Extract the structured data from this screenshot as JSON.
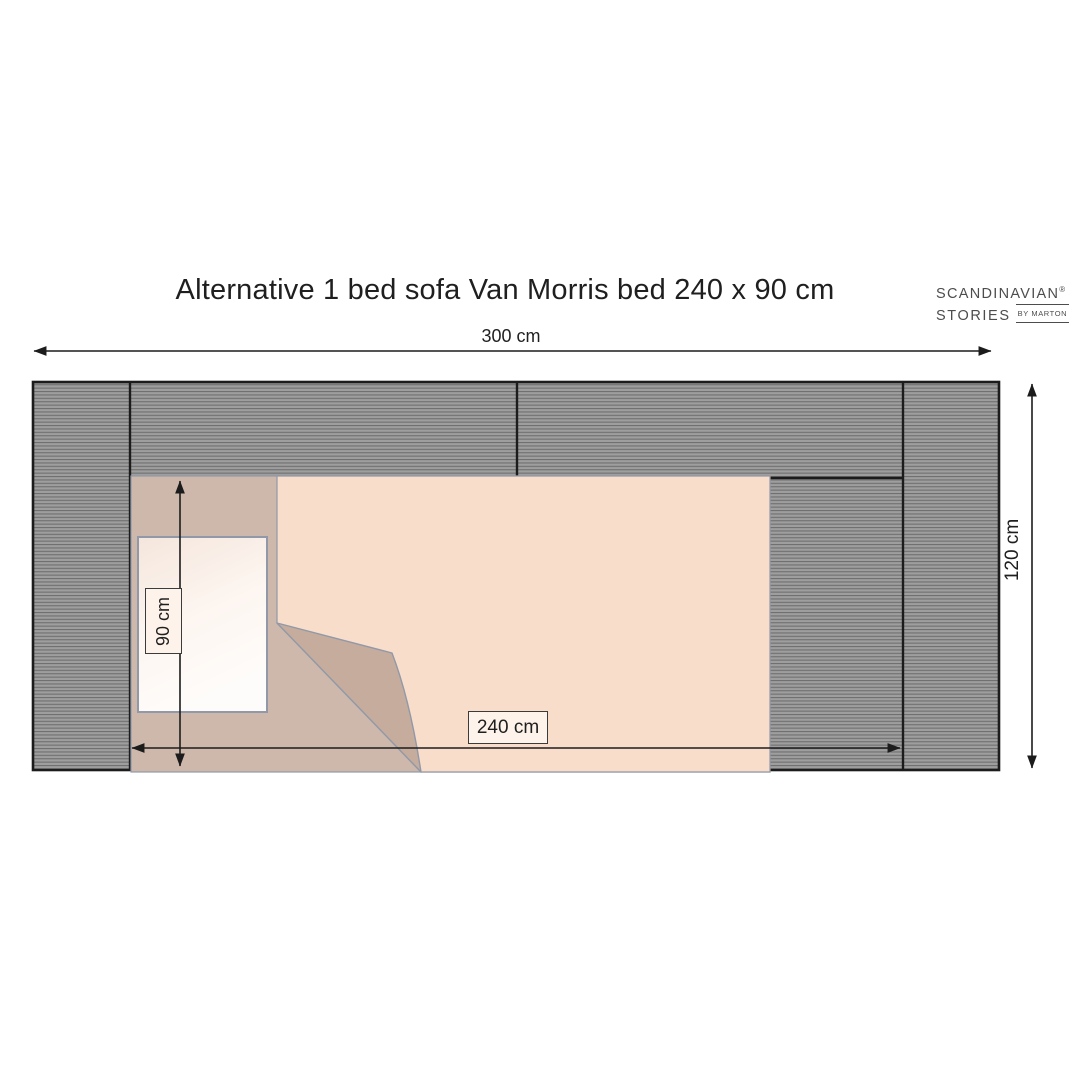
{
  "title": "Alternative 1 bed sofa Van Morris bed 240 x 90 cm",
  "logo": {
    "line1": "SCANDINAVIAN",
    "registered_mark": "®",
    "line2": "STORIES",
    "byline": "BY MARTON"
  },
  "dimension_labels": {
    "overall_width": "300 cm",
    "overall_depth": "120 cm",
    "bed_length": "240 cm",
    "bed_width": "90 cm"
  },
  "diagram": {
    "type": "furniture-floor-plan",
    "sofa": {
      "overall_width_cm": 300,
      "overall_depth_cm": 120,
      "sections": [
        "left-armrest",
        "backrest-left",
        "backrest-right",
        "seat",
        "right-armrest"
      ],
      "fill_style": "horizontal-hatch"
    },
    "bed": {
      "length_cm": 240,
      "width_cm": 90,
      "parts": [
        "mattress",
        "blanket",
        "folded-blanket-corner",
        "pillow"
      ]
    }
  },
  "colors": {
    "background": "#ffffff",
    "sofa_hatch_base": "#9e9e9e",
    "sofa_hatch_line": "#6f6f6f",
    "sofa_outline": "#1c1c1c",
    "mattress": "#cdb8ab",
    "blanket": "#f9ddcb",
    "fold": "#c6ac9d",
    "pillow_light": "#fefcfa",
    "pillow_shade": "#f5e6dc",
    "soft_outline": "#9199a8",
    "dimension_line": "#1c1c1c",
    "label_box_bg": "#fdf3ea",
    "label_box_border": "#3b3b3b",
    "text": "#1f1f1f",
    "logo_text": "#4d4d4d"
  }
}
